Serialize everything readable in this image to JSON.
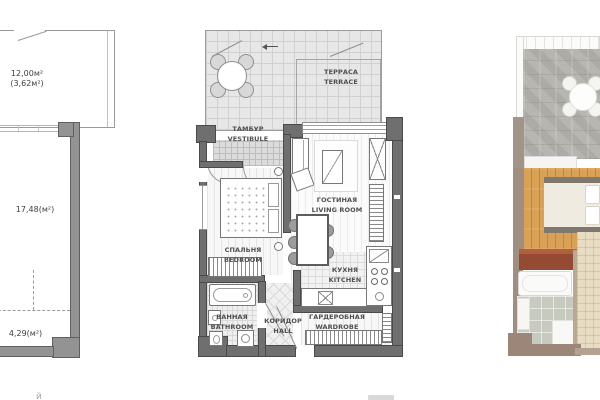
{
  "left_plan": {
    "terrace_area": "12,00м²",
    "terrace_area_secondary": "(3,62м²)",
    "main_area": "17,48(м²)",
    "niche_area": "4,29(м²)"
  },
  "detailed_plan": {
    "rooms": [
      {
        "ru": "ТЕРРАСА",
        "en": "TERRACE"
      },
      {
        "ru": "ТАМБУР",
        "en": "VESTIBULE"
      },
      {
        "ru": "ГОСТИНАЯ",
        "en": "LIVING ROOM"
      },
      {
        "ru": "СПАЛЬНЯ",
        "en": "BEDROOM"
      },
      {
        "ru": "КУХНЯ",
        "en": "KITCHEN"
      },
      {
        "ru": "ВАННАЯ",
        "en": "BATHROOM"
      },
      {
        "ru": "КОРИДОР",
        "en": "HALL"
      },
      {
        "ru": "ГАРДЕРОБНАЯ",
        "en": "WARDROBE"
      }
    ]
  },
  "colors": {
    "plan_wall": "#6f6f6f",
    "schematic_wall": "#939393",
    "render_wall": "#9c8579",
    "render_wood_floor": "#d9a155",
    "render_stone_floor": "#b3b2ad",
    "render_bath_tile": "#c7cabf",
    "render_hall_tile": "#e8dcc3",
    "render_dresser": "#954a33"
  },
  "footer": {
    "fragment_left": "й"
  }
}
